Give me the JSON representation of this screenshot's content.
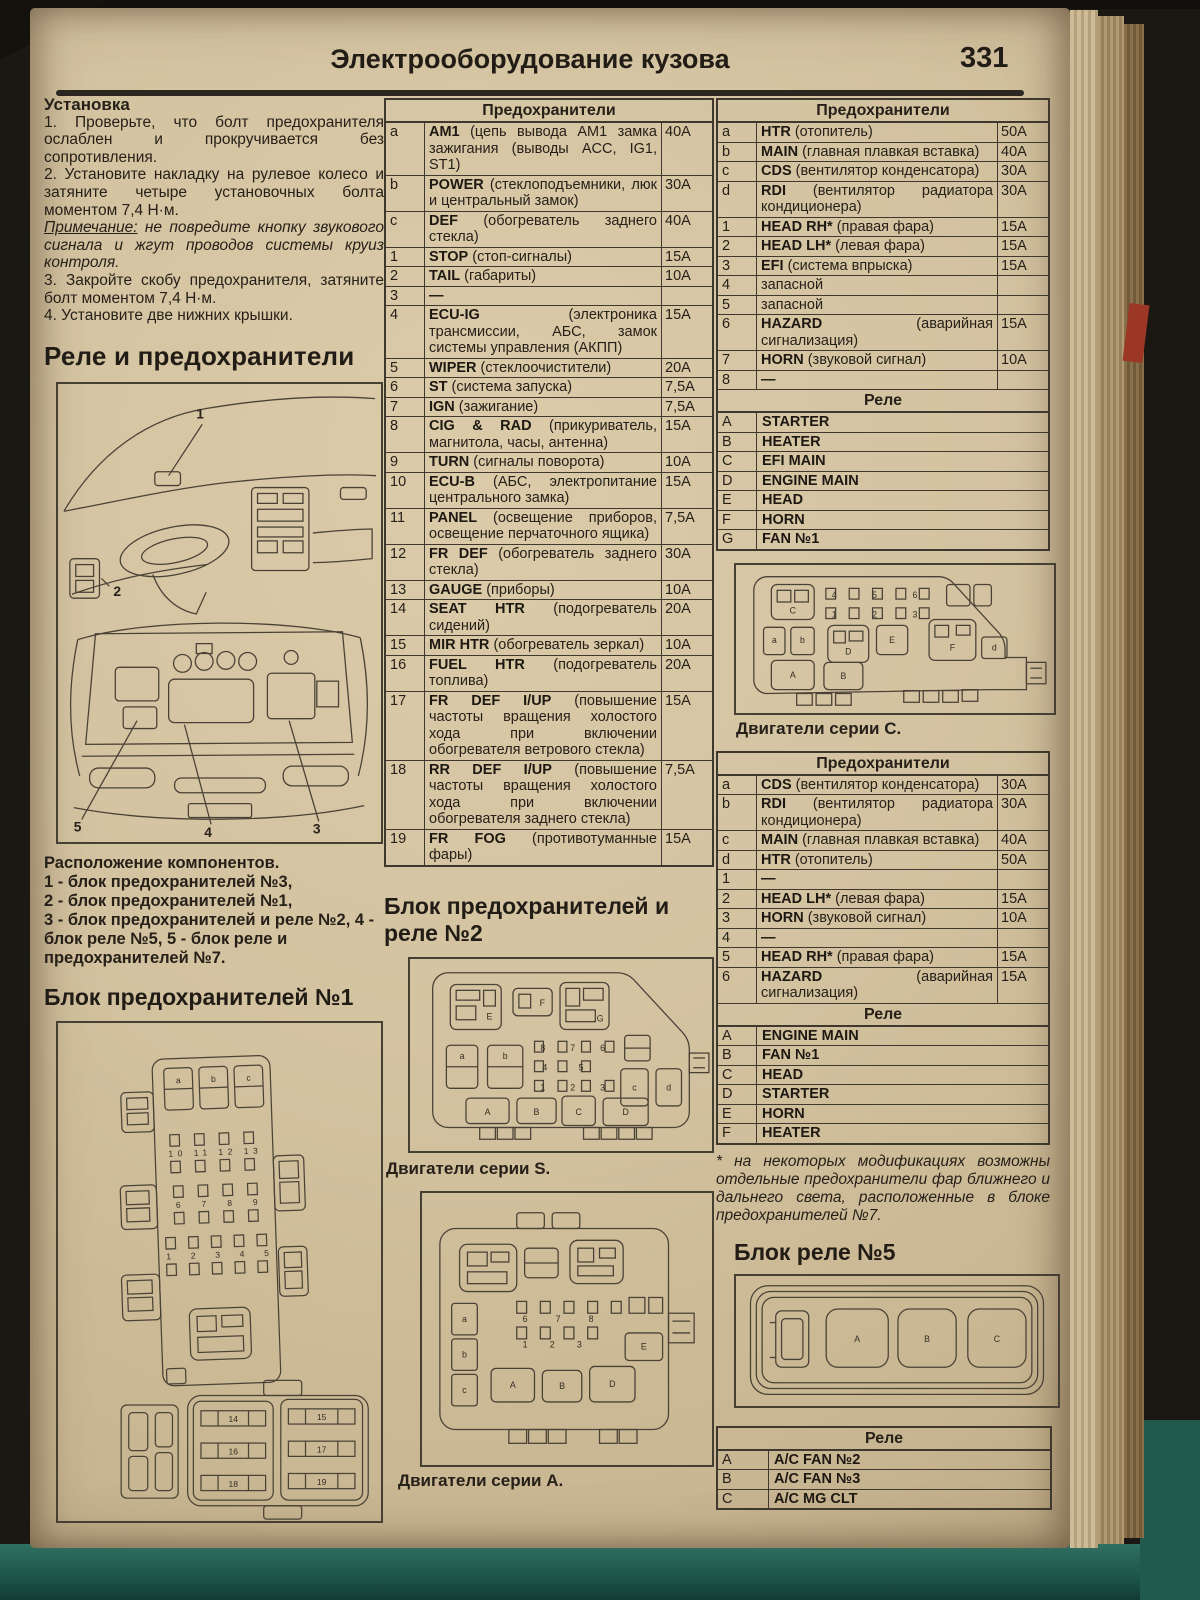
{
  "page": {
    "title": "Электрооборудование кузова",
    "number": "331"
  },
  "install": {
    "heading": "Установка",
    "steps": [
      "1. Проверьте, что болт предохранителя ослаблен и прокручивается без сопротивления.",
      "2. Установите накладку на рулевое колесо и затяните четыре установочных болта моментом 7,4 Н·м."
    ],
    "note_label": "Примечание:",
    "note_text": " не повредите кнопку звукового сигнала и жгут проводов системы круиз контроля.",
    "steps2": [
      "3. Закройте скобу предохранителя, затяните болт моментом 7,4 Н·м.",
      "4. Установите две нижних крышки."
    ]
  },
  "relays_fuses_heading": "Реле и предохранители",
  "component_location": {
    "title": "Расположение компонентов.",
    "lines": [
      "1 - блок предохранителей №3,",
      "2 - блок предохранителей №1,",
      "3 - блок предохранителей и реле №2, 4 - блок реле №5, 5 - блок реле и предохранителей №7."
    ]
  },
  "fusebox1_heading": "Блок предохранителей №1",
  "fusebox2_heading": "Блок предохранителей и реле №2",
  "relaybox5_heading": "Блок реле №5",
  "footnote": "* на некоторых модификациях возможны отдельные предохранители фар ближнего и дальнего света, расположенные в блоке предохранителей №7.",
  "captions": {
    "series_s": "Двигатели серии S.",
    "series_a": "Двигатели серии A.",
    "series_c": "Двигатели серии C."
  },
  "fuse_table_main": {
    "title": "Предохранители",
    "rows": [
      {
        "id": "a",
        "name": "AM1",
        "desc": " (цепь вывода AM1 замка зажигания (выводы ACC, IG1, ST1)",
        "amp": "40A"
      },
      {
        "id": "b",
        "name": "POWER",
        "desc": " (стеклоподъемники, люк и центральный замок)",
        "amp": "30A"
      },
      {
        "id": "c",
        "name": "DEF",
        "desc": " (обогреватель заднего стекла)",
        "amp": "40A"
      },
      {
        "id": "1",
        "name": "STOP",
        "desc": " (стоп-сигналы)",
        "amp": "15A"
      },
      {
        "id": "2",
        "name": "TAIL",
        "desc": " (габариты)",
        "amp": "10A"
      },
      {
        "id": "3",
        "name": "—",
        "desc": "",
        "amp": ""
      },
      {
        "id": "4",
        "name": "ECU-IG",
        "desc": " (электроника трансмиссии, АБС, замок системы управления (АКПП)",
        "amp": "15A"
      },
      {
        "id": "5",
        "name": "WIPER",
        "desc": " (стеклоочистители)",
        "amp": "20A"
      },
      {
        "id": "6",
        "name": "ST",
        "desc": " (система запуска)",
        "amp": "7,5A"
      },
      {
        "id": "7",
        "name": "IGN",
        "desc": " (зажигание)",
        "amp": "7,5A"
      },
      {
        "id": "8",
        "name": "CIG & RAD",
        "desc": " (прикуриватель, магнитола, часы, антенна)",
        "amp": "15A"
      },
      {
        "id": "9",
        "name": "TURN",
        "desc": " (сигналы поворота)",
        "amp": "10A"
      },
      {
        "id": "10",
        "name": "ECU-B",
        "desc": " (АБС, электропитание центрального замка)",
        "amp": "15A"
      },
      {
        "id": "11",
        "name": "PANEL",
        "desc": " (освещение приборов, освещение перчаточного ящика)",
        "amp": "7,5A"
      },
      {
        "id": "12",
        "name": "FR DEF",
        "desc": " (обогреватель заднего стекла)",
        "amp": "30A"
      },
      {
        "id": "13",
        "name": "GAUGE",
        "desc": " (приборы)",
        "amp": "10A"
      },
      {
        "id": "14",
        "name": "SEAT HTR",
        "desc": " (подогреватель сидений)",
        "amp": "20A"
      },
      {
        "id": "15",
        "name": "MIR HTR",
        "desc": " (обогреватель зеркал)",
        "amp": "10A"
      },
      {
        "id": "16",
        "name": "FUEL HTR",
        "desc": " (подогреватель топлива)",
        "amp": "20A"
      },
      {
        "id": "17",
        "name": "FR DEF I/UP",
        "desc": " (повышение частоты вращения холостого хода при включении обогревателя ветрового стекла)",
        "amp": "15A"
      },
      {
        "id": "18",
        "name": "RR DEF I/UP",
        "desc": " (повышение частоты вращения холостого хода при включении обогревателя заднего стекла)",
        "amp": "7,5A"
      },
      {
        "id": "19",
        "name": "FR FOG",
        "desc": " (противотуманные фары)",
        "amp": "15A"
      }
    ]
  },
  "fuse_table_r1": {
    "title": "Предохранители",
    "rows": [
      {
        "id": "a",
        "name": "HTR",
        "desc": " (отопитель)",
        "amp": "50A"
      },
      {
        "id": "b",
        "name": "MAIN",
        "desc": " (главная плавкая вставка)",
        "amp": "40A"
      },
      {
        "id": "c",
        "name": "CDS",
        "desc": " (вентилятор конденсатора)",
        "amp": "30A"
      },
      {
        "id": "d",
        "name": "RDI",
        "desc": " (вентилятор радиатора кондиционера)",
        "amp": "30A"
      },
      {
        "id": "1",
        "name": "HEAD RH*",
        "desc": " (правая фара)",
        "amp": "15A"
      },
      {
        "id": "2",
        "name": "HEAD LH*",
        "desc": " (левая фара)",
        "amp": "15A"
      },
      {
        "id": "3",
        "name": "EFI",
        "desc": " (система впрыска)",
        "amp": "15A"
      },
      {
        "id": "4",
        "name": "",
        "desc": "запасной",
        "amp": ""
      },
      {
        "id": "5",
        "name": "",
        "desc": "запасной",
        "amp": ""
      },
      {
        "id": "6",
        "name": "HAZARD",
        "desc": " (аварийная сигнализация)",
        "amp": "15A"
      },
      {
        "id": "7",
        "name": "HORN",
        "desc": " (звуковой сигнал)",
        "amp": "10A"
      },
      {
        "id": "8",
        "name": "—",
        "desc": "",
        "amp": ""
      }
    ],
    "relay_title": "Реле",
    "relays": [
      {
        "id": "A",
        "name": "STARTER"
      },
      {
        "id": "B",
        "name": "HEATER"
      },
      {
        "id": "C",
        "name": "EFI MAIN"
      },
      {
        "id": "D",
        "name": "ENGINE MAIN"
      },
      {
        "id": "E",
        "name": "HEAD"
      },
      {
        "id": "F",
        "name": "HORN"
      },
      {
        "id": "G",
        "name": "FAN №1"
      }
    ]
  },
  "fuse_table_r2": {
    "title": "Предохранители",
    "rows": [
      {
        "id": "a",
        "name": "CDS",
        "desc": " (вентилятор конденсатора)",
        "amp": "30A"
      },
      {
        "id": "b",
        "name": "RDI",
        "desc": " (вентилятор радиатора кондиционера)",
        "amp": "30A"
      },
      {
        "id": "c",
        "name": "MAIN",
        "desc": " (главная плавкая вставка)",
        "amp": "40A"
      },
      {
        "id": "d",
        "name": "HTR",
        "desc": " (отопитель)",
        "amp": "50A"
      },
      {
        "id": "1",
        "name": "—",
        "desc": "",
        "amp": ""
      },
      {
        "id": "2",
        "name": "HEAD LH*",
        "desc": " (левая фара)",
        "amp": "15A"
      },
      {
        "id": "3",
        "name": "HORN",
        "desc": " (звуковой сигнал)",
        "amp": "10A"
      },
      {
        "id": "4",
        "name": "—",
        "desc": "",
        "amp": ""
      },
      {
        "id": "5",
        "name": "HEAD RH*",
        "desc": " (правая фара)",
        "amp": "15A"
      },
      {
        "id": "6",
        "name": "HAZARD",
        "desc": " (аварийная сигнализация)",
        "amp": "15A"
      }
    ],
    "relay_title": "Реле",
    "relays": [
      {
        "id": "A",
        "name": "ENGINE MAIN"
      },
      {
        "id": "B",
        "name": "FAN №1"
      },
      {
        "id": "C",
        "name": "HEAD"
      },
      {
        "id": "D",
        "name": "STARTER"
      },
      {
        "id": "E",
        "name": "HORN"
      },
      {
        "id": "F",
        "name": "HEATER"
      }
    ]
  },
  "relay_table_5": {
    "title": "Реле",
    "rows": [
      {
        "id": "A",
        "name": "A/C FAN №2"
      },
      {
        "id": "B",
        "name": "A/C FAN №3"
      },
      {
        "id": "C",
        "name": "A/C MG CLT"
      }
    ]
  },
  "diagrams": {
    "car": {
      "l1": "1",
      "l2": "2",
      "l3": "3",
      "l4": "4",
      "l5": "5"
    },
    "fusebox1": {
      "top": [
        "a",
        "b",
        "c"
      ],
      "row1": "10 11 12 13",
      "row2": "6 7 8 9",
      "row3": "1 2 3 4 5",
      "lowL": [
        "14",
        "16",
        "18"
      ],
      "lowR": [
        "15",
        "17",
        "19"
      ]
    },
    "sS": {
      "top": [
        "E",
        "F",
        "G"
      ],
      "left": [
        "a",
        "b"
      ],
      "right": [
        "c",
        "d"
      ],
      "bottom": [
        "A",
        "B",
        "C",
        "D"
      ],
      "r1": "8 7 6",
      "r2": "4 5",
      "r3": "1 2 3"
    },
    "sA": {
      "left": [
        "a",
        "b",
        "c"
      ],
      "bottom": [
        "A",
        "B",
        "D",
        "E"
      ],
      "r1": "6 7 8",
      "r2": "1 2 3"
    },
    "sC": {
      "c": "C",
      "e": "E",
      "f": "F",
      "d": "d",
      "a": "a",
      "b": "b",
      "dd": "D",
      "aa": "A",
      "bb": "B",
      "r1": "4 5 6",
      "r2": "1 2 3"
    },
    "r5": {
      "a": "A",
      "b": "B",
      "c": "C"
    }
  }
}
